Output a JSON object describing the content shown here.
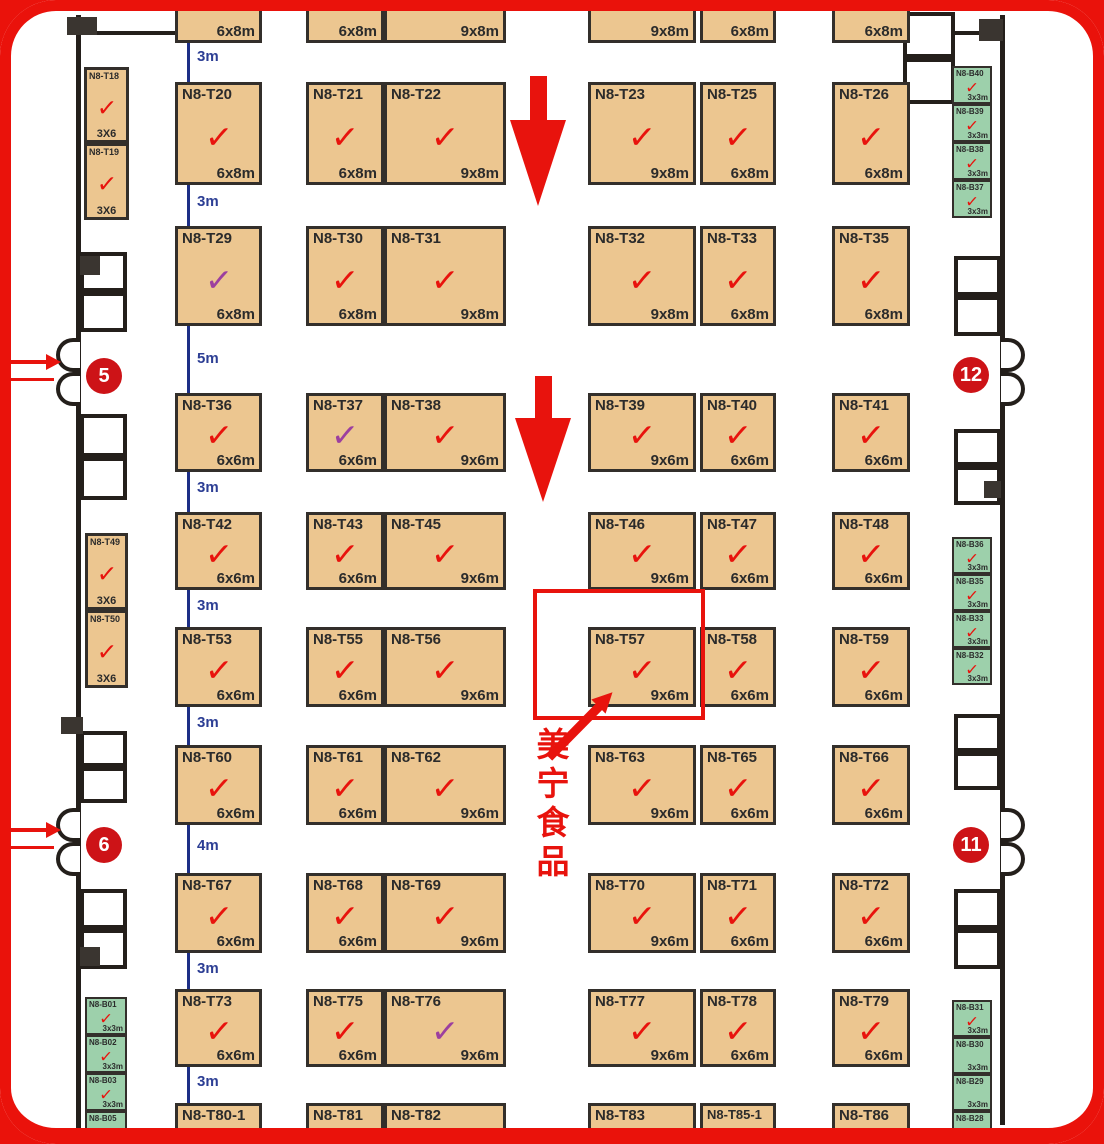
{
  "colors": {
    "booth_tan": "#ecc690",
    "booth_green": "#9dd0ab",
    "accent_red": "#e8130d",
    "check_purple": "#9c3f9f",
    "dim_blue": "#2c3e94",
    "wall_dark": "#241f1b",
    "gate_red": "#cd1317"
  },
  "highlight": {
    "company_label": "美宁食品",
    "booth": "N8-T57",
    "rect": {
      "x": 533,
      "y": 589,
      "w": 172,
      "h": 131
    },
    "arrow": {
      "x1": 549,
      "y1": 757,
      "x2": 613,
      "y2": 692
    },
    "label_pos": {
      "x": 534,
      "y": 727
    }
  },
  "gates": [
    {
      "number": "5",
      "cx": 104,
      "cy": 376,
      "side": "left",
      "arrow_y": 356,
      "line_y": 378
    },
    {
      "number": "6",
      "cx": 104,
      "cy": 845,
      "side": "left",
      "arrow_y": 824,
      "line_y": 846
    },
    {
      "number": "12",
      "cx": 971,
      "cy": 375,
      "side": "right"
    },
    {
      "number": "11",
      "cx": 971,
      "cy": 845,
      "side": "right"
    }
  ],
  "aisle_arrows": [
    {
      "cx": 538,
      "top": 76,
      "shaft_h": 44,
      "head_h": 86,
      "shaft_w": 17,
      "head_w": 56
    },
    {
      "cx": 543,
      "top": 376,
      "shaft_h": 42,
      "head_h": 84,
      "shaft_w": 17,
      "head_w": 56
    }
  ],
  "dims": [
    {
      "label": "3m",
      "top": 43,
      "bottom": 82,
      "ly": 48
    },
    {
      "label": "3m",
      "top": 185,
      "bottom": 226,
      "ly": 193
    },
    {
      "label": "5m",
      "top": 326,
      "bottom": 393,
      "ly": 350
    },
    {
      "label": "3m",
      "top": 470,
      "bottom": 512,
      "ly": 479
    },
    {
      "label": "3m",
      "top": 590,
      "bottom": 627,
      "ly": 597
    },
    {
      "label": "3m",
      "top": 707,
      "bottom": 745,
      "ly": 714
    },
    {
      "label": "4m",
      "top": 825,
      "bottom": 873,
      "ly": 837
    },
    {
      "label": "3m",
      "top": 953,
      "bottom": 989,
      "ly": 960
    },
    {
      "label": "3m",
      "top": 1067,
      "bottom": 1103,
      "ly": 1073
    }
  ],
  "booths": [
    {
      "name": "",
      "size": "6x8m",
      "x": 175,
      "y": -55,
      "w": 87,
      "h": 98,
      "kind": "main",
      "check": "none"
    },
    {
      "name": "",
      "size": "6x8m",
      "x": 306,
      "y": -55,
      "w": 78,
      "h": 98,
      "kind": "main",
      "check": "none"
    },
    {
      "name": "",
      "size": "9x8m",
      "x": 384,
      "y": -55,
      "w": 122,
      "h": 98,
      "kind": "main",
      "check": "purple"
    },
    {
      "name": "",
      "size": "9x8m",
      "x": 588,
      "y": -55,
      "w": 108,
      "h": 98,
      "kind": "main",
      "check": "none"
    },
    {
      "name": "",
      "size": "6x8m",
      "x": 700,
      "y": -55,
      "w": 76,
      "h": 98,
      "kind": "main",
      "check": "none"
    },
    {
      "name": "",
      "size": "6x8m",
      "x": 832,
      "y": -55,
      "w": 78,
      "h": 98,
      "kind": "main",
      "check": "none"
    },
    {
      "name": "N8-T20",
      "size": "6x8m",
      "x": 175,
      "y": 82,
      "w": 87,
      "h": 103,
      "kind": "main",
      "check": "red"
    },
    {
      "name": "N8-T21",
      "size": "6x8m",
      "x": 306,
      "y": 82,
      "w": 78,
      "h": 103,
      "kind": "main",
      "check": "red"
    },
    {
      "name": "N8-T22",
      "size": "9x8m",
      "x": 384,
      "y": 82,
      "w": 122,
      "h": 103,
      "kind": "main",
      "check": "red"
    },
    {
      "name": "N8-T23",
      "size": "9x8m",
      "x": 588,
      "y": 82,
      "w": 108,
      "h": 103,
      "kind": "main",
      "check": "red"
    },
    {
      "name": "N8-T25",
      "size": "6x8m",
      "x": 700,
      "y": 82,
      "w": 76,
      "h": 103,
      "kind": "main",
      "check": "red"
    },
    {
      "name": "N8-T26",
      "size": "6x8m",
      "x": 832,
      "y": 82,
      "w": 78,
      "h": 103,
      "kind": "main",
      "check": "red"
    },
    {
      "name": "N8-T29",
      "size": "6x8m",
      "x": 175,
      "y": 226,
      "w": 87,
      "h": 100,
      "kind": "main",
      "check": "purple"
    },
    {
      "name": "N8-T30",
      "size": "6x8m",
      "x": 306,
      "y": 226,
      "w": 78,
      "h": 100,
      "kind": "main",
      "check": "red"
    },
    {
      "name": "N8-T31",
      "size": "9x8m",
      "x": 384,
      "y": 226,
      "w": 122,
      "h": 100,
      "kind": "main",
      "check": "red"
    },
    {
      "name": "N8-T32",
      "size": "9x8m",
      "x": 588,
      "y": 226,
      "w": 108,
      "h": 100,
      "kind": "main",
      "check": "red"
    },
    {
      "name": "N8-T33",
      "size": "6x8m",
      "x": 700,
      "y": 226,
      "w": 76,
      "h": 100,
      "kind": "main",
      "check": "red"
    },
    {
      "name": "N8-T35",
      "size": "6x8m",
      "x": 832,
      "y": 226,
      "w": 78,
      "h": 100,
      "kind": "main",
      "check": "red"
    },
    {
      "name": "N8-T36",
      "size": "6x6m",
      "x": 175,
      "y": 393,
      "w": 87,
      "h": 79,
      "kind": "main",
      "check": "red"
    },
    {
      "name": "N8-T37",
      "size": "6x6m",
      "x": 306,
      "y": 393,
      "w": 78,
      "h": 79,
      "kind": "main",
      "check": "purple"
    },
    {
      "name": "N8-T38",
      "size": "9x6m",
      "x": 384,
      "y": 393,
      "w": 122,
      "h": 79,
      "kind": "main",
      "check": "red"
    },
    {
      "name": "N8-T39",
      "size": "9x6m",
      "x": 588,
      "y": 393,
      "w": 108,
      "h": 79,
      "kind": "main",
      "check": "red"
    },
    {
      "name": "N8-T40",
      "size": "6x6m",
      "x": 700,
      "y": 393,
      "w": 76,
      "h": 79,
      "kind": "main",
      "check": "red"
    },
    {
      "name": "N8-T41",
      "size": "6x6m",
      "x": 832,
      "y": 393,
      "w": 78,
      "h": 79,
      "kind": "main",
      "check": "red"
    },
    {
      "name": "N8-T42",
      "size": "6x6m",
      "x": 175,
      "y": 512,
      "w": 87,
      "h": 78,
      "kind": "main",
      "check": "red"
    },
    {
      "name": "N8-T43",
      "size": "6x6m",
      "x": 306,
      "y": 512,
      "w": 78,
      "h": 78,
      "kind": "main",
      "check": "red"
    },
    {
      "name": "N8-T45",
      "size": "9x6m",
      "x": 384,
      "y": 512,
      "w": 122,
      "h": 78,
      "kind": "main",
      "check": "red"
    },
    {
      "name": "N8-T46",
      "size": "9x6m",
      "x": 588,
      "y": 512,
      "w": 108,
      "h": 78,
      "kind": "main",
      "check": "red"
    },
    {
      "name": "N8-T47",
      "size": "6x6m",
      "x": 700,
      "y": 512,
      "w": 76,
      "h": 78,
      "kind": "main",
      "check": "red"
    },
    {
      "name": "N8-T48",
      "size": "6x6m",
      "x": 832,
      "y": 512,
      "w": 78,
      "h": 78,
      "kind": "main",
      "check": "red"
    },
    {
      "name": "N8-T53",
      "size": "6x6m",
      "x": 175,
      "y": 627,
      "w": 87,
      "h": 80,
      "kind": "main",
      "check": "red"
    },
    {
      "name": "N8-T55",
      "size": "6x6m",
      "x": 306,
      "y": 627,
      "w": 78,
      "h": 80,
      "kind": "main",
      "check": "red"
    },
    {
      "name": "N8-T56",
      "size": "9x6m",
      "x": 384,
      "y": 627,
      "w": 122,
      "h": 80,
      "kind": "main",
      "check": "red"
    },
    {
      "name": "N8-T57",
      "size": "9x6m",
      "x": 588,
      "y": 627,
      "w": 108,
      "h": 80,
      "kind": "main",
      "check": "red"
    },
    {
      "name": "N8-T58",
      "size": "6x6m",
      "x": 700,
      "y": 627,
      "w": 76,
      "h": 80,
      "kind": "main",
      "check": "red"
    },
    {
      "name": "N8-T59",
      "size": "6x6m",
      "x": 832,
      "y": 627,
      "w": 78,
      "h": 80,
      "kind": "main",
      "check": "red"
    },
    {
      "name": "N8-T60",
      "size": "6x6m",
      "x": 175,
      "y": 745,
      "w": 87,
      "h": 80,
      "kind": "main",
      "check": "red"
    },
    {
      "name": "N8-T61",
      "size": "6x6m",
      "x": 306,
      "y": 745,
      "w": 78,
      "h": 80,
      "kind": "main",
      "check": "red"
    },
    {
      "name": "N8-T62",
      "size": "9x6m",
      "x": 384,
      "y": 745,
      "w": 122,
      "h": 80,
      "kind": "main",
      "check": "red"
    },
    {
      "name": "N8-T63",
      "size": "9x6m",
      "x": 588,
      "y": 745,
      "w": 108,
      "h": 80,
      "kind": "main",
      "check": "red"
    },
    {
      "name": "N8-T65",
      "size": "6x6m",
      "x": 700,
      "y": 745,
      "w": 76,
      "h": 80,
      "kind": "main",
      "check": "red"
    },
    {
      "name": "N8-T66",
      "size": "6x6m",
      "x": 832,
      "y": 745,
      "w": 78,
      "h": 80,
      "kind": "main",
      "check": "red"
    },
    {
      "name": "N8-T67",
      "size": "6x6m",
      "x": 175,
      "y": 873,
      "w": 87,
      "h": 80,
      "kind": "main",
      "check": "red"
    },
    {
      "name": "N8-T68",
      "size": "6x6m",
      "x": 306,
      "y": 873,
      "w": 78,
      "h": 80,
      "kind": "main",
      "check": "red"
    },
    {
      "name": "N8-T69",
      "size": "9x6m",
      "x": 384,
      "y": 873,
      "w": 122,
      "h": 80,
      "kind": "main",
      "check": "red"
    },
    {
      "name": "N8-T70",
      "size": "9x6m",
      "x": 588,
      "y": 873,
      "w": 108,
      "h": 80,
      "kind": "main",
      "check": "red"
    },
    {
      "name": "N8-T71",
      "size": "6x6m",
      "x": 700,
      "y": 873,
      "w": 76,
      "h": 80,
      "kind": "main",
      "check": "red"
    },
    {
      "name": "N8-T72",
      "size": "6x6m",
      "x": 832,
      "y": 873,
      "w": 78,
      "h": 80,
      "kind": "main",
      "check": "red"
    },
    {
      "name": "N8-T73",
      "size": "6x6m",
      "x": 175,
      "y": 989,
      "w": 87,
      "h": 78,
      "kind": "main",
      "check": "red"
    },
    {
      "name": "N8-T75",
      "size": "6x6m",
      "x": 306,
      "y": 989,
      "w": 78,
      "h": 78,
      "kind": "main",
      "check": "red"
    },
    {
      "name": "N8-T76",
      "size": "9x6m",
      "x": 384,
      "y": 989,
      "w": 122,
      "h": 78,
      "kind": "main",
      "check": "purple"
    },
    {
      "name": "N8-T77",
      "size": "9x6m",
      "x": 588,
      "y": 989,
      "w": 108,
      "h": 78,
      "kind": "main",
      "check": "red"
    },
    {
      "name": "N8-T78",
      "size": "6x6m",
      "x": 700,
      "y": 989,
      "w": 76,
      "h": 78,
      "kind": "main",
      "check": "red"
    },
    {
      "name": "N8-T79",
      "size": "6x6m",
      "x": 832,
      "y": 989,
      "w": 78,
      "h": 78,
      "kind": "main",
      "check": "red"
    },
    {
      "name": "N8-T80-1",
      "size": "",
      "x": 175,
      "y": 1103,
      "w": 87,
      "h": 65,
      "kind": "main",
      "check": "red"
    },
    {
      "name": "N8-T81",
      "size": "",
      "x": 306,
      "y": 1103,
      "w": 78,
      "h": 65,
      "kind": "main",
      "check": "red"
    },
    {
      "name": "N8-T82",
      "size": "",
      "x": 384,
      "y": 1103,
      "w": 122,
      "h": 65,
      "kind": "main",
      "check": "red"
    },
    {
      "name": "N8-T83",
      "size": "",
      "x": 588,
      "y": 1103,
      "w": 108,
      "h": 65,
      "kind": "main",
      "check": "red"
    },
    {
      "name": "N8-T85-1",
      "size": "",
      "x": 700,
      "y": 1103,
      "w": 76,
      "h": 65,
      "kind": "main",
      "check": "red"
    },
    {
      "name": "N8-T86",
      "size": "",
      "x": 832,
      "y": 1103,
      "w": 78,
      "h": 65,
      "kind": "main",
      "check": "red"
    },
    {
      "name": "N8-T18",
      "size": "3X6",
      "x": 84,
      "y": 67,
      "w": 45,
      "h": 76,
      "kind": "side",
      "check": "red"
    },
    {
      "name": "N8-T19",
      "size": "3X6",
      "x": 84,
      "y": 143,
      "w": 45,
      "h": 77,
      "kind": "side",
      "check": "red"
    },
    {
      "name": "N8-T49",
      "size": "3X6",
      "x": 85,
      "y": 533,
      "w": 43,
      "h": 77,
      "kind": "side",
      "check": "red"
    },
    {
      "name": "N8-T50",
      "size": "3X6",
      "x": 85,
      "y": 610,
      "w": 43,
      "h": 78,
      "kind": "side",
      "check": "red"
    },
    {
      "name": "N8-B40",
      "size": "3x3m",
      "x": 952,
      "y": 66,
      "w": 40,
      "h": 38,
      "kind": "green",
      "check": "red"
    },
    {
      "name": "N8-B39",
      "size": "3x3m",
      "x": 952,
      "y": 104,
      "w": 40,
      "h": 38,
      "kind": "green",
      "check": "red"
    },
    {
      "name": "N8-B38",
      "size": "3x3m",
      "x": 952,
      "y": 142,
      "w": 40,
      "h": 38,
      "kind": "green",
      "check": "red"
    },
    {
      "name": "N8-B37",
      "size": "3x3m",
      "x": 952,
      "y": 180,
      "w": 40,
      "h": 38,
      "kind": "green",
      "check": "red"
    },
    {
      "name": "N8-B36",
      "size": "3x3m",
      "x": 952,
      "y": 537,
      "w": 40,
      "h": 37,
      "kind": "green",
      "check": "red"
    },
    {
      "name": "N8-B35",
      "size": "3x3m",
      "x": 952,
      "y": 574,
      "w": 40,
      "h": 37,
      "kind": "green",
      "check": "red"
    },
    {
      "name": "N8-B33",
      "size": "3x3m",
      "x": 952,
      "y": 611,
      "w": 40,
      "h": 37,
      "kind": "green",
      "check": "red"
    },
    {
      "name": "N8-B32",
      "size": "3x3m",
      "x": 952,
      "y": 648,
      "w": 40,
      "h": 37,
      "kind": "green",
      "check": "red"
    },
    {
      "name": "N8-B31",
      "size": "3x3m",
      "x": 952,
      "y": 1000,
      "w": 40,
      "h": 37,
      "kind": "green",
      "check": "red"
    },
    {
      "name": "N8-B30",
      "size": "3x3m",
      "x": 952,
      "y": 1037,
      "w": 40,
      "h": 37,
      "kind": "green",
      "check": "none"
    },
    {
      "name": "N8-B29",
      "size": "3x3m",
      "x": 952,
      "y": 1074,
      "w": 40,
      "h": 37,
      "kind": "green",
      "check": "none"
    },
    {
      "name": "N8-B28",
      "size": "",
      "x": 952,
      "y": 1111,
      "w": 40,
      "h": 37,
      "kind": "green",
      "check": "red"
    },
    {
      "name": "N8-B01",
      "size": "3x3m",
      "x": 85,
      "y": 997,
      "w": 42,
      "h": 38,
      "kind": "green",
      "check": "red"
    },
    {
      "name": "N8-B02",
      "size": "3x3m",
      "x": 85,
      "y": 1035,
      "w": 42,
      "h": 38,
      "kind": "green",
      "check": "red"
    },
    {
      "name": "N8-B03",
      "size": "3x3m",
      "x": 85,
      "y": 1073,
      "w": 42,
      "h": 38,
      "kind": "green",
      "check": "red"
    },
    {
      "name": "N8-B05",
      "size": "",
      "x": 85,
      "y": 1111,
      "w": 42,
      "h": 38,
      "kind": "green",
      "check": "red"
    }
  ]
}
